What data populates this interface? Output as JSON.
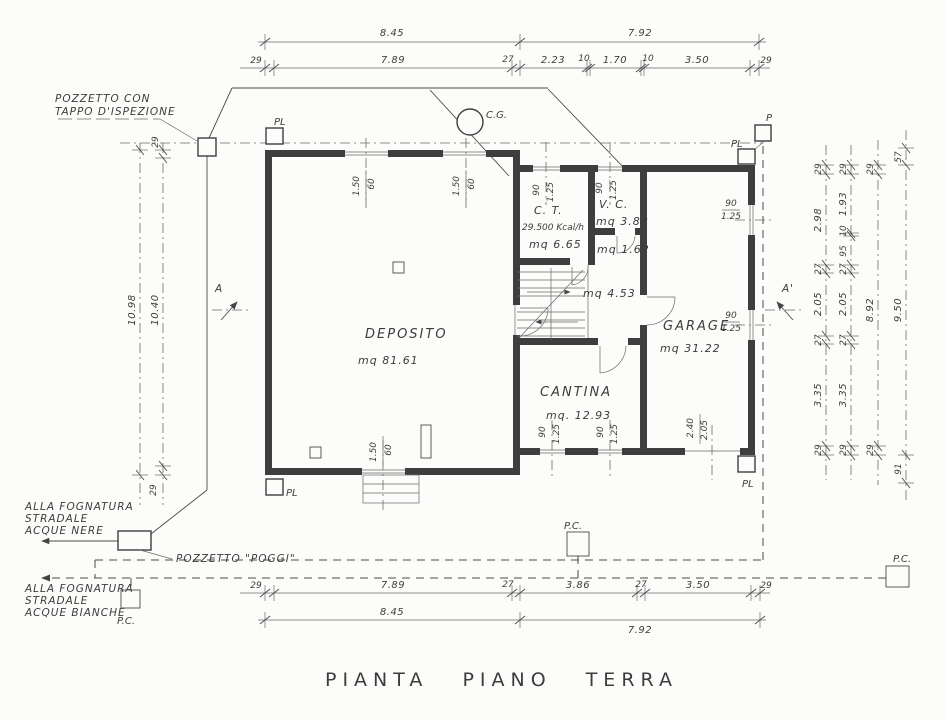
{
  "colors": {
    "ink": "#3e3e3e",
    "paper": "#fcfcfa",
    "dim_line": "#6a6a6a"
  },
  "labels": {
    "title": "PIANTA  PIANO  TERRA",
    "pozzetto_ispezione": [
      "POZZETTO  CON",
      "TAPPO  D'ISPEZIONE"
    ],
    "acque_nere": [
      "ALLA  FOGNATURA",
      "STRADALE",
      "ACQUE  NERE"
    ],
    "pozzetto_poggi": "POZZETTO  \"POGGI\"",
    "acque_bianche": [
      "ALLA  FOGNATURA",
      "STRADALE",
      "ACQUE  BIANCHE"
    ],
    "cg": "C.G.",
    "p": "P",
    "pl": "PL",
    "pc": "P.C.",
    "section_a": "A",
    "section_a_prime": "A'"
  },
  "rooms": {
    "deposito": {
      "name": "DEPOSITO",
      "area": "mq 81.61"
    },
    "ct": {
      "name": "C. T.",
      "power": "29.500 Kcal/h",
      "area": "mq 6.65"
    },
    "vc": {
      "name": "V. C.",
      "area": "mq 3.88"
    },
    "disimpegno": {
      "area": "mq 1.62"
    },
    "hall": {
      "area": "mq 4.53"
    },
    "cantina": {
      "name": "CANTINA",
      "area": "mq. 12.93"
    },
    "garage": {
      "name": "GARAGE",
      "area": "mq 31.22"
    }
  },
  "dims": {
    "top_row1": [
      "8.45",
      "7.92"
    ],
    "top_row2": [
      "29",
      "7.89",
      "27",
      "2.23",
      "10",
      "1.70",
      "10",
      "3.50",
      "29"
    ],
    "bottom_row1": [
      "29",
      "7.89",
      "27",
      "3.86",
      "27",
      "3.50",
      "29"
    ],
    "bottom_row2": [
      "8.45",
      "7.92"
    ],
    "left_outer": "10.98",
    "left_inner": [
      "29",
      "10.40",
      "29"
    ],
    "right_col1": [
      "29",
      "2.98",
      "27",
      "2.05",
      "27",
      "3.35",
      "29"
    ],
    "right_col2": [
      "29",
      "1.93",
      "10",
      "95",
      "27",
      "2.05",
      "27",
      "3.35",
      "29"
    ],
    "right_col3": [
      "29",
      "8.92",
      "29"
    ],
    "right_col4": [
      "57",
      "9.50",
      "91"
    ],
    "window_150_60": [
      "1.50",
      "60"
    ],
    "window_90_125": [
      "90",
      "1.25"
    ],
    "garage_door": [
      "2.40",
      "2.05"
    ]
  }
}
